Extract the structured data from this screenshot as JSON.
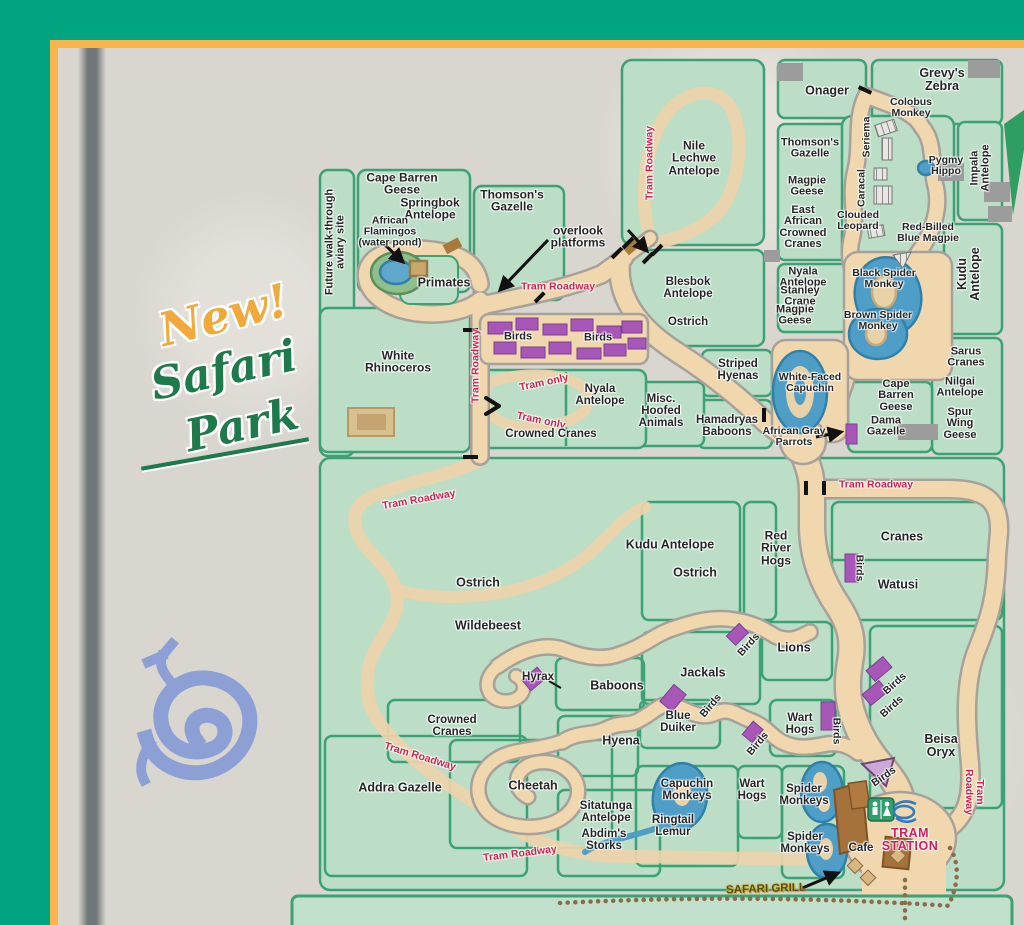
{
  "decor": {
    "new_text": "New!",
    "park_word1": "Safari",
    "park_word2": "Park"
  },
  "colors": {
    "teal": "#00A580",
    "frame_yellow": "#F9B54C",
    "paper": "#D9D5CF",
    "enclosure_green": "#BCDEC6",
    "fence_green": "#3BA275",
    "path_tan": "#F1D7AE",
    "path_edge": "#A6A29B",
    "water_blue": "#5FA8CC",
    "birds_purple": "#A757B8",
    "tram_red": "#D61F4B",
    "station_pink": "#D31C5C",
    "label_dark": "#262626",
    "petroglyph_blue": "#8CA0D6",
    "script_green": "#1F7A4B",
    "script_orange": "#F2A93C",
    "grill_gold": "#5B4D10"
  },
  "map": {
    "labels": [
      {
        "name": "future-aviary",
        "text": "Future walk-through\naviary site",
        "x": 336,
        "y": 242,
        "rot": -90,
        "size": 11
      },
      {
        "name": "cape-barren-geese-nw",
        "text": "Cape Barren\nGeese",
        "x": 402,
        "y": 184,
        "rot": 0,
        "size": 12
      },
      {
        "name": "springbok-antelope",
        "text": "Springbok\nAntelope",
        "x": 430,
        "y": 209,
        "rot": 0,
        "size": 12
      },
      {
        "name": "thomsons-gazelle-nw",
        "text": "Thomson's\nGazelle",
        "x": 512,
        "y": 201,
        "rot": 0,
        "size": 12
      },
      {
        "name": "african-flamingos",
        "text": "African\nFlamingos\n(water pond)",
        "x": 390,
        "y": 232,
        "rot": 0,
        "size": 10.5
      },
      {
        "name": "primates",
        "text": "Primates",
        "x": 444,
        "y": 283,
        "rot": 0,
        "size": 12.5
      },
      {
        "name": "overlook-platforms",
        "text": "overlook\nplatforms",
        "x": 578,
        "y": 237,
        "rot": 0,
        "size": 12
      },
      {
        "name": "tram-roadway-primates",
        "text": "Tram Roadway",
        "x": 558,
        "y": 287,
        "rot": 0,
        "size": 10.5,
        "cls": "red"
      },
      {
        "name": "nile-lechwe",
        "text": "Nile\nLechwe\nAntelope",
        "x": 694,
        "y": 158,
        "rot": 0,
        "size": 12
      },
      {
        "name": "tram-roadway-nile",
        "text": "Tram Roadway",
        "x": 650,
        "y": 163,
        "rot": -90,
        "size": 10.5,
        "cls": "red"
      },
      {
        "name": "onager",
        "text": "Onager",
        "x": 827,
        "y": 91,
        "rot": 0,
        "size": 12.5
      },
      {
        "name": "grevys-zebra",
        "text": "Grevy's\nZebra",
        "x": 942,
        "y": 80,
        "rot": 0,
        "size": 12.5
      },
      {
        "name": "colobus-monkey",
        "text": "Colobus\nMonkey",
        "x": 911,
        "y": 108,
        "rot": 0,
        "size": 10.5
      },
      {
        "name": "seriema",
        "text": "Seriema",
        "x": 867,
        "y": 137,
        "rot": -90,
        "size": 10.5
      },
      {
        "name": "caracal",
        "text": "Caracal",
        "x": 862,
        "y": 188,
        "rot": -90,
        "size": 10.5
      },
      {
        "name": "thomsons-gazelle-ne",
        "text": "Thomson's\nGazelle",
        "x": 810,
        "y": 149,
        "rot": 0,
        "size": 11
      },
      {
        "name": "magpie-geese-1",
        "text": "Magpie\nGeese",
        "x": 807,
        "y": 187,
        "rot": 0,
        "size": 11
      },
      {
        "name": "ea-crowned-cranes",
        "text": "East\nAfrican\nCrowned\nCranes",
        "x": 803,
        "y": 228,
        "rot": 0,
        "size": 11
      },
      {
        "name": "pygmy-hippo",
        "text": "Pygmy\nHippo",
        "x": 946,
        "y": 166,
        "rot": 0,
        "size": 10.5
      },
      {
        "name": "impala-antelope",
        "text": "Impala\nAntelope",
        "x": 981,
        "y": 168,
        "rot": -90,
        "size": 11
      },
      {
        "name": "clouded-leopard",
        "text": "Clouded\nLeopard",
        "x": 858,
        "y": 221,
        "rot": 0,
        "size": 10.5
      },
      {
        "name": "red-billed-blue-magpie",
        "text": "Red-Billed\nBlue Magpie",
        "x": 928,
        "y": 233,
        "rot": 0,
        "size": 10.5
      },
      {
        "name": "kudu-antelope-ne",
        "text": "Kudu\nAntelope",
        "x": 969,
        "y": 274,
        "rot": -90,
        "size": 12.5
      },
      {
        "name": "nyala-antelope-ne",
        "text": "Nyala\nAntelope",
        "x": 803,
        "y": 278,
        "rot": 0,
        "size": 11
      },
      {
        "name": "stanley-crane",
        "text": "Stanley\nCrane",
        "x": 800,
        "y": 297,
        "rot": 0,
        "size": 11
      },
      {
        "name": "magpie-geese-2",
        "text": "Magpie\nGeese",
        "x": 795,
        "y": 316,
        "rot": 0,
        "size": 11
      },
      {
        "name": "black-spider-monkey",
        "text": "Black Spider\nMonkey",
        "x": 884,
        "y": 279,
        "rot": 0,
        "size": 10.5
      },
      {
        "name": "brown-spider-monkey",
        "text": "Brown Spider\nMonkey",
        "x": 878,
        "y": 321,
        "rot": 0,
        "size": 10.5
      },
      {
        "name": "sarus-cranes",
        "text": "Sarus\nCranes",
        "x": 966,
        "y": 358,
        "rot": 0,
        "size": 11
      },
      {
        "name": "nilgai-antelope",
        "text": "Nilgai\nAntelope",
        "x": 960,
        "y": 388,
        "rot": 0,
        "size": 11
      },
      {
        "name": "white-faced-capuchin",
        "text": "White-Faced\nCapuchin",
        "x": 810,
        "y": 383,
        "rot": 0,
        "size": 10.5
      },
      {
        "name": "cape-barren-geese-ne",
        "text": "Cape\nBarren\nGeese",
        "x": 896,
        "y": 396,
        "rot": 0,
        "size": 11
      },
      {
        "name": "dama-gazelle",
        "text": "Dama\nGazelle",
        "x": 886,
        "y": 427,
        "rot": 0,
        "size": 11
      },
      {
        "name": "spur-wing-geese",
        "text": "Spur\nWing\nGeese",
        "x": 960,
        "y": 424,
        "rot": 0,
        "size": 11
      },
      {
        "name": "african-gray-parrots",
        "text": "African Gray\nParrots",
        "x": 794,
        "y": 437,
        "rot": 0,
        "size": 10.5
      },
      {
        "name": "blesbok-antelope",
        "text": "Blesbok\nAntelope",
        "x": 688,
        "y": 289,
        "rot": 0,
        "size": 11.5
      },
      {
        "name": "ostrich-n",
        "text": "Ostrich",
        "x": 688,
        "y": 323,
        "rot": 0,
        "size": 11.5
      },
      {
        "name": "striped-hyenas",
        "text": "Striped\nHyenas",
        "x": 738,
        "y": 371,
        "rot": 0,
        "size": 11.5
      },
      {
        "name": "white-rhinoceros",
        "text": "White\nRhinoceros",
        "x": 398,
        "y": 362,
        "rot": 0,
        "size": 12
      },
      {
        "name": "birds-aviary-1",
        "text": "Birds",
        "x": 518,
        "y": 337,
        "rot": 0,
        "size": 11
      },
      {
        "name": "birds-aviary-2",
        "text": "Birds",
        "x": 598,
        "y": 338,
        "rot": 0,
        "size": 11
      },
      {
        "name": "tram-roadway-nw-vert",
        "text": "Tram Roadway",
        "x": 476,
        "y": 366,
        "rot": -90,
        "size": 10.5,
        "cls": "red"
      },
      {
        "name": "tram-only-1",
        "text": "Tram only",
        "x": 544,
        "y": 383,
        "rot": -12,
        "size": 10.5,
        "cls": "red"
      },
      {
        "name": "tram-only-2",
        "text": "Tram only",
        "x": 541,
        "y": 421,
        "rot": 12,
        "size": 10.5,
        "cls": "red"
      },
      {
        "name": "nyala-antelope-c",
        "text": "Nyala\nAntelope",
        "x": 600,
        "y": 396,
        "rot": 0,
        "size": 11.5
      },
      {
        "name": "misc-hoofed",
        "text": "Misc.\nHoofed\nAnimals",
        "x": 661,
        "y": 412,
        "rot": 0,
        "size": 11.5
      },
      {
        "name": "crowned-cranes-c",
        "text": "Crowned Cranes",
        "x": 551,
        "y": 435,
        "rot": 0,
        "size": 11.5
      },
      {
        "name": "hamadryas-baboons",
        "text": "Hamadryas\nBaboons",
        "x": 727,
        "y": 427,
        "rot": 0,
        "size": 11.5
      },
      {
        "name": "tram-roadway-east",
        "text": "Tram Roadway",
        "x": 876,
        "y": 485,
        "rot": 0,
        "size": 10.5,
        "cls": "red"
      },
      {
        "name": "kudu-antelope-s",
        "text": "Kudu Antelope",
        "x": 670,
        "y": 545,
        "rot": 0,
        "size": 12.5
      },
      {
        "name": "ostrich-center",
        "text": "Ostrich",
        "x": 695,
        "y": 573,
        "rot": 0,
        "size": 12.5
      },
      {
        "name": "red-river-hogs",
        "text": "Red\nRiver\nHogs",
        "x": 776,
        "y": 548,
        "rot": 0,
        "size": 12
      },
      {
        "name": "cranes",
        "text": "Cranes",
        "x": 902,
        "y": 537,
        "rot": 0,
        "size": 12.5
      },
      {
        "name": "birds-cranes",
        "text": "Birds",
        "x": 859,
        "y": 568,
        "rot": 90,
        "size": 10.5
      },
      {
        "name": "watusi",
        "text": "Watusi",
        "x": 898,
        "y": 585,
        "rot": 0,
        "size": 12.5
      },
      {
        "name": "ostrich-sw",
        "text": "Ostrich",
        "x": 478,
        "y": 583,
        "rot": 0,
        "size": 12.5
      },
      {
        "name": "wildebeest",
        "text": "Wildebeest",
        "x": 488,
        "y": 626,
        "rot": 0,
        "size": 12.5
      },
      {
        "name": "tram-roadway-sw",
        "text": "Tram Roadway",
        "x": 419,
        "y": 500,
        "rot": -10,
        "size": 10.5,
        "cls": "red"
      },
      {
        "name": "hyrax",
        "text": "Hyrax",
        "x": 538,
        "y": 678,
        "rot": 0,
        "size": 11.5
      },
      {
        "name": "baboons",
        "text": "Baboons",
        "x": 617,
        "y": 686,
        "rot": 0,
        "size": 12.5
      },
      {
        "name": "jackals",
        "text": "Jackals",
        "x": 703,
        "y": 673,
        "rot": 0,
        "size": 12.5
      },
      {
        "name": "lions",
        "text": "Lions",
        "x": 794,
        "y": 648,
        "rot": 0,
        "size": 12.5
      },
      {
        "name": "birds-lions",
        "text": "Birds",
        "x": 749,
        "y": 645,
        "rot": -48,
        "size": 10.5
      },
      {
        "name": "blue-duiker",
        "text": "Blue\nDuiker",
        "x": 678,
        "y": 723,
        "rot": 0,
        "size": 11.5
      },
      {
        "name": "birds-duiker",
        "text": "Birds",
        "x": 711,
        "y": 706,
        "rot": -50,
        "size": 10.5
      },
      {
        "name": "hyena",
        "text": "Hyena",
        "x": 621,
        "y": 741,
        "rot": 0,
        "size": 12.5
      },
      {
        "name": "birds-hyena",
        "text": "Birds",
        "x": 758,
        "y": 744,
        "rot": -50,
        "size": 10.5
      },
      {
        "name": "wart-hogs-n",
        "text": "Wart\nHogs",
        "x": 800,
        "y": 725,
        "rot": 0,
        "size": 11.5
      },
      {
        "name": "birds-warthogs",
        "text": "Birds",
        "x": 836,
        "y": 731,
        "rot": 90,
        "size": 10.5
      },
      {
        "name": "birds-beisa-1",
        "text": "Birds",
        "x": 895,
        "y": 684,
        "rot": -42,
        "size": 10.5
      },
      {
        "name": "birds-beisa-2",
        "text": "Birds",
        "x": 892,
        "y": 707,
        "rot": -42,
        "size": 10.5
      },
      {
        "name": "beisa-oryx",
        "text": "Beisa\nOryx",
        "x": 941,
        "y": 746,
        "rot": 0,
        "size": 12.5
      },
      {
        "name": "tram-roadway-se",
        "text": "Tram Roadway",
        "x": 974,
        "y": 792,
        "rot": 90,
        "size": 10.5,
        "cls": "red"
      },
      {
        "name": "crowned-cranes-sw",
        "text": "Crowned\nCranes",
        "x": 452,
        "y": 727,
        "rot": 0,
        "size": 11.5
      },
      {
        "name": "addra-gazelle",
        "text": "Addra Gazelle",
        "x": 400,
        "y": 788,
        "rot": 0,
        "size": 12.5
      },
      {
        "name": "tram-roadway-addra",
        "text": "Tram Roadway",
        "x": 420,
        "y": 757,
        "rot": 17,
        "size": 10.5,
        "cls": "red"
      },
      {
        "name": "cheetah",
        "text": "Cheetah",
        "x": 533,
        "y": 786,
        "rot": 0,
        "size": 12.5
      },
      {
        "name": "sitatunga-antelope",
        "text": "Sitatunga\nAntelope",
        "x": 606,
        "y": 813,
        "rot": 0,
        "size": 11.5
      },
      {
        "name": "capuchin-monkeys",
        "text": "Capuchin\nMonkeys",
        "x": 687,
        "y": 791,
        "rot": 0,
        "size": 11.5
      },
      {
        "name": "ringtail-lemur",
        "text": "Ringtail\nLemur",
        "x": 673,
        "y": 827,
        "rot": 0,
        "size": 11.5
      },
      {
        "name": "abdims-storks",
        "text": "Abdim's\nStorks",
        "x": 604,
        "y": 841,
        "rot": 0,
        "size": 11.5
      },
      {
        "name": "wart-hogs-s",
        "text": "Wart\nHogs",
        "x": 752,
        "y": 791,
        "rot": 0,
        "size": 11.5
      },
      {
        "name": "spider-monkeys-1",
        "text": "Spider\nMonkeys",
        "x": 804,
        "y": 796,
        "rot": 0,
        "size": 11.5
      },
      {
        "name": "spider-monkeys-2",
        "text": "Spider\nMonkeys",
        "x": 805,
        "y": 844,
        "rot": 0,
        "size": 11.5
      },
      {
        "name": "cafe",
        "text": "Cafe",
        "x": 861,
        "y": 849,
        "rot": 0,
        "size": 11.5
      },
      {
        "name": "birds-station",
        "text": "Birds",
        "x": 884,
        "y": 777,
        "rot": -35,
        "size": 10.5
      },
      {
        "name": "tram-station",
        "text": "TRAM\nSTATION",
        "x": 910,
        "y": 840,
        "rot": 0,
        "size": 12.5,
        "cls": "crimson"
      },
      {
        "name": "safari-grill",
        "text": "SAFARI GRILL",
        "x": 766,
        "y": 890,
        "rot": -2,
        "size": 11.5,
        "cls": "gold"
      },
      {
        "name": "tram-roadway-bottom",
        "text": "Tram Roadway",
        "x": 520,
        "y": 854,
        "rot": -7,
        "size": 10.5,
        "cls": "red"
      }
    ]
  }
}
